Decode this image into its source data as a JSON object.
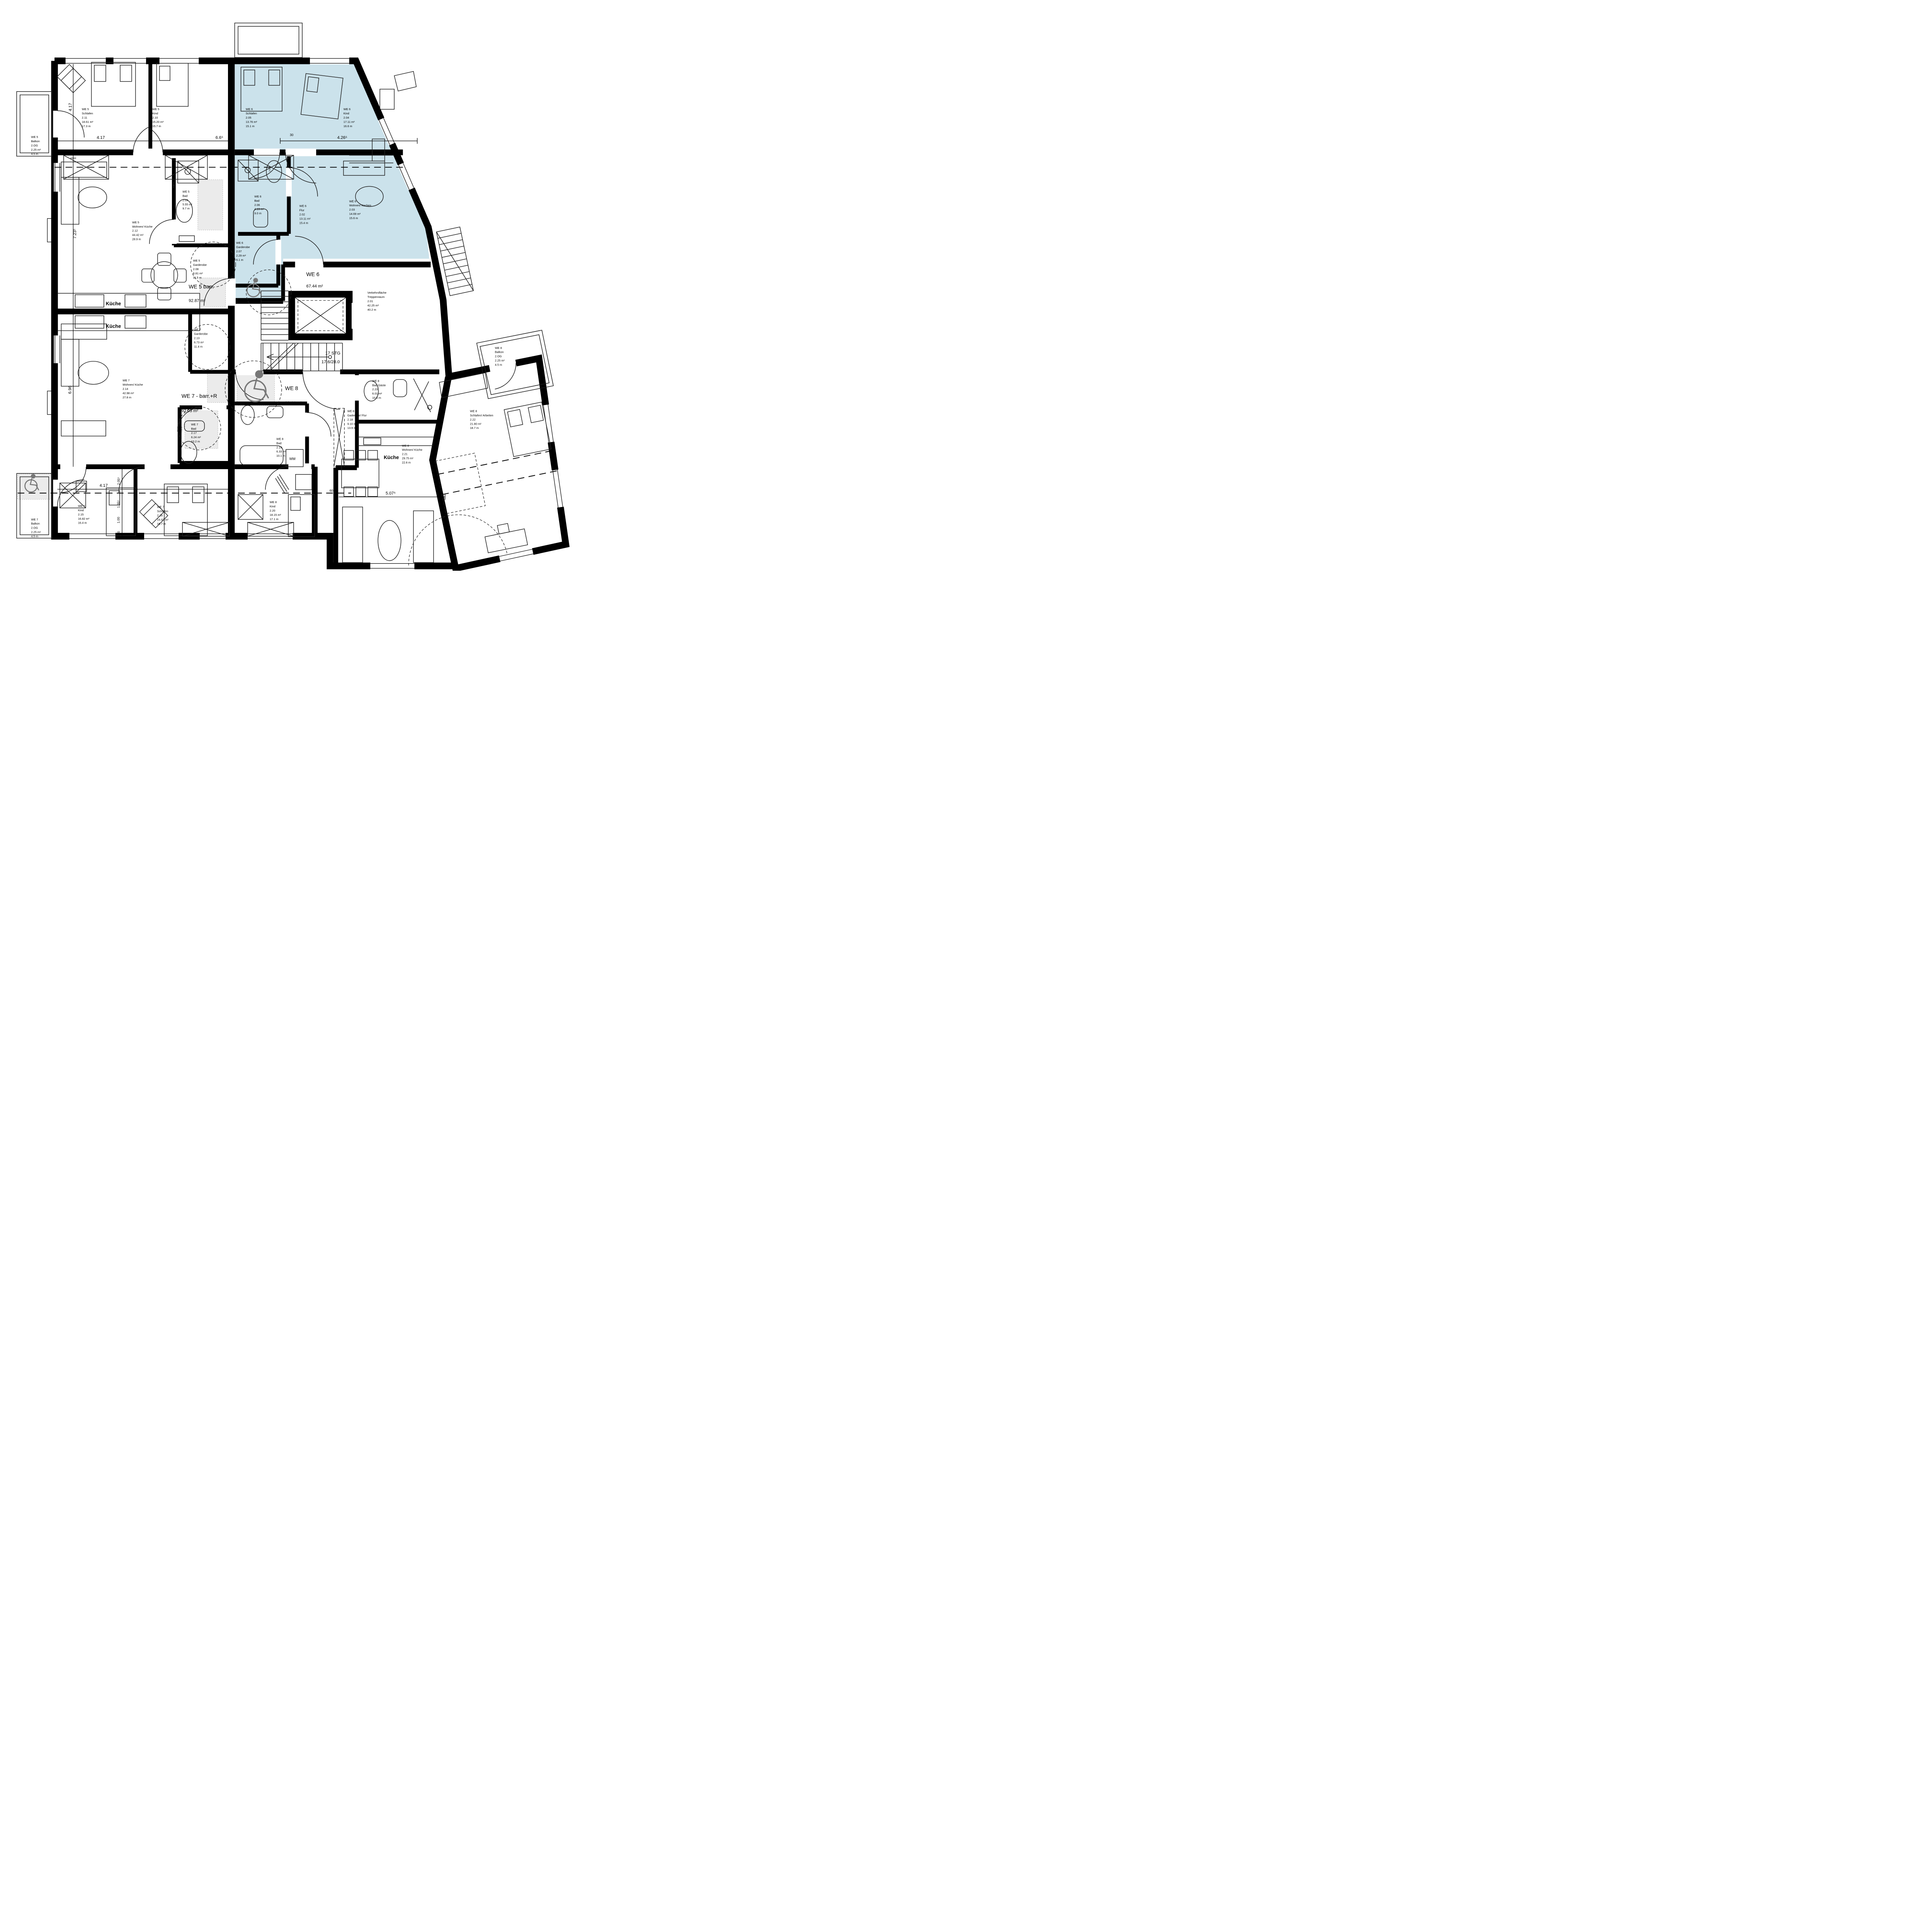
{
  "plan_title": "Grundriss 2.OG - WE 5 / WE 6 / WE 7 / WE 8",
  "colors": {
    "we6_highlight": "#cbe2eb",
    "barrier_free_zone": "#ebebeb",
    "wheelchair_icon": "#777777",
    "walls": "#000000"
  },
  "apartments": {
    "we5": {
      "label": "WE 5 barr.",
      "area": "92.87 m²"
    },
    "we6": {
      "label": "WE 6",
      "area": "67.44 m²"
    },
    "we7": {
      "label": "WE 7 - barr.+R",
      "area": "92.03 m²"
    },
    "we8": {
      "label": "WE 8",
      "area": "93.44 m²"
    }
  },
  "stairwell": [
    "Verkehrsfläche",
    "Treppenraum",
    "2.01",
    "42.25 m²",
    "40.2 m"
  ],
  "stairs": {
    "line1": "17 STG",
    "line2": "17.6/28.0"
  },
  "rooms": {
    "we5_balkon": [
      "WE 5",
      "Balkon",
      "2.OG",
      "2.25 m²",
      "4.5 m"
    ],
    "we5_schlafen": [
      "WE 5",
      "Schlafen",
      "2.11",
      "18.61 m²",
      "17.3 m"
    ],
    "we5_kind": [
      "WE 5",
      "Kind",
      "2.10",
      "15.20 m²",
      "15.7 m"
    ],
    "we5_bad": [
      "WE 5",
      "Bad",
      "2.09",
      "5.55 m²",
      "9.7 m"
    ],
    "we5_wohnen": [
      "WE 5",
      "Wohnen/ Küche",
      "2.12",
      "44.42 m²",
      "28.9 m"
    ],
    "we5_garderobe": [
      "WE 5",
      "Garderobe",
      "2.08",
      "6.81 m²",
      "11.5 m"
    ],
    "we6_schlafen": [
      "WE 6",
      "Schlafen",
      "2.05",
      "13.76 m²",
      "15.1 m"
    ],
    "we6_kind": [
      "WE 6",
      "Kind",
      "2.04",
      "17.11 m²",
      "16.6 m"
    ],
    "we6_bad": [
      "WE 6",
      "Bad",
      "2.06",
      "4.19 m²",
      "9.0 m"
    ],
    "we6_flur": [
      "WE 6",
      "Flur",
      "2.02",
      "13.11 m²",
      "15.4 m"
    ],
    "we6_wohnen": [
      "WE 6",
      "Wohnen/ Kochen",
      "2.03",
      "14.69 m²",
      "15.6 m"
    ],
    "we6_garderobe": [
      "WE 6",
      "Garderobe",
      "2.07",
      "2.29 m²",
      "6.1 m"
    ],
    "we7_garderobe": [
      "WE 7",
      "Garderobe",
      "2.13",
      "6.73 m²",
      "11.4 m"
    ],
    "we7_wohnen": [
      "WE 7",
      "Wohnen/ Küche",
      "2.14",
      "42.98 m²",
      "27.8 m"
    ],
    "we7_bad": [
      "WE 7",
      "Bad",
      "2.17",
      "6.24 m²",
      "10.2 m"
    ],
    "we7_kind": [
      "WE 7",
      "Kind",
      "2.15",
      "16.82 m²",
      "16.4 m"
    ],
    "we7_schlafen": [
      "WE 7",
      "Schlafen",
      "2.16",
      "16.97 m²",
      "16.7 m"
    ],
    "we7_balkon": [
      "WE 7",
      "Balkon",
      "2.OG",
      "2.25 m²",
      "4.5 m"
    ],
    "we8_badgaeste": [
      "WE 8",
      "Bad Gäste",
      "2.23",
      "6.01 m²",
      "10.5 m"
    ],
    "we8_gaderobe": [
      "WE 8",
      "Gaderobe/ Flur",
      "2.18",
      "9.10 m²",
      "13.9 m"
    ],
    "we8_bad": [
      "WE 8",
      "Bad",
      "2.19",
      "6.33 m²",
      "10.1 m"
    ],
    "we8_wohnen": [
      "WE 8",
      "Wohnen/ Küche",
      "2.21",
      "29.75 m²",
      "22.6 m"
    ],
    "we8_kind": [
      "WE 8",
      "Kind",
      "2.20",
      "18.15 m²",
      "17.1 m"
    ],
    "we8_schlafen": [
      "WE 8",
      "Schlafen/ Arbeiten",
      "2.22",
      "21.80 m²",
      "18.7 m"
    ],
    "we8_balkon": [
      "WE 8",
      "Balkon",
      "2.OG",
      "2.25 m²",
      "4.5 m"
    ]
  },
  "labels": {
    "kueche": "Küche",
    "wm": "WM",
    "hkv": "HKV"
  },
  "dimensions": {
    "v417": "4.17",
    "h417_top": "4.17",
    "d665": "6.6⁵",
    "d30": "30",
    "d4265": "4.26⁵",
    "d7235": "7.23⁵",
    "d696": "6.96",
    "h417_bottom": "4.17",
    "d1355": "1.35⁵",
    "d2055": "2.05⁵",
    "d100": "1.00",
    "d90": "90",
    "d60": "60",
    "d5075": "5.07⁵"
  }
}
